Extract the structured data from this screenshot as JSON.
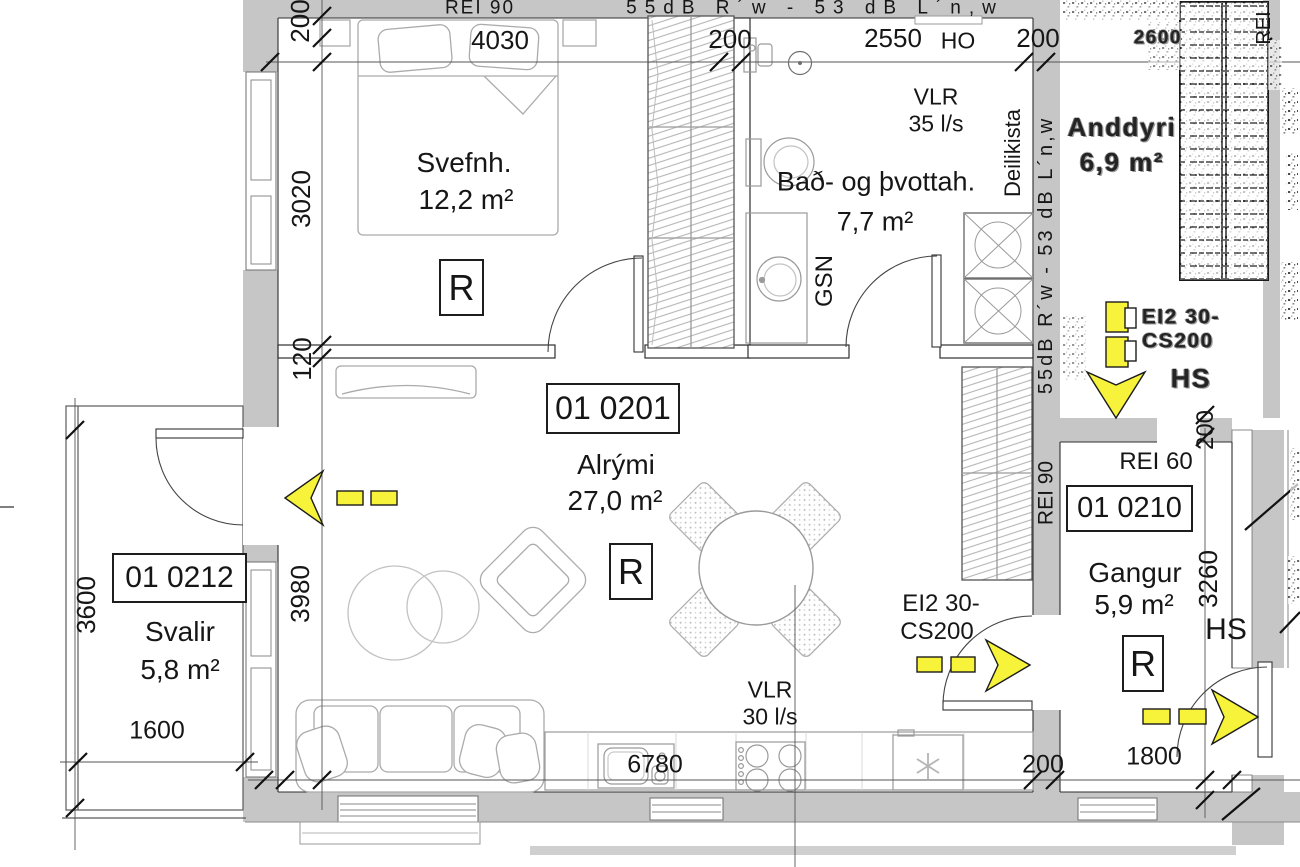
{
  "plan": {
    "rooms": {
      "alrymi": {
        "id": "01 0201",
        "name": "Alrými",
        "area": "27,0 m²"
      },
      "svefnherbergi": {
        "name": "Svefnh.",
        "area": "12,2 m²"
      },
      "bad_og_thvottahus": {
        "name": "Bað- og þvottah.",
        "area": "7,7 m²"
      },
      "svalir": {
        "id": "01 0212",
        "name": "Svalir",
        "area": "5,8 m²"
      },
      "gangur": {
        "id": "01 0210",
        "name": "Gangur",
        "area": "5,9 m²"
      },
      "anddyri": {
        "name": "Anddyri",
        "area": "6,9 m²"
      }
    },
    "radiator": "R",
    "fire": {
      "top_rei": "REI 90",
      "top_sound": "55dB R´w - 53 dB L´n,w",
      "right_sound": "55dB R´w - 53 dB L´n,w",
      "right_rei": "REI 90",
      "gangur_rei": "REI 60",
      "stair_rei": "REI",
      "door_l1": "EI2 30-",
      "door_l2": "CS200",
      "door_noisy_l1": "EI2 30-",
      "door_noisy_l2": "CS200"
    },
    "vent": {
      "bath_l1": "VLR",
      "bath_l2": "35 l/s",
      "kitchen_l1": "VLR",
      "kitchen_l2": "30 l/s"
    },
    "labels": {
      "ho": "HO",
      "gsn": "GSN",
      "deilikista": "Deilikista",
      "hs": "HS",
      "hs_noisy": "HS"
    },
    "dims": {
      "top_4030": "4030",
      "top_200a": "200",
      "top_2550": "2550",
      "top_200b": "200",
      "left_200": "200",
      "left_3020": "3020",
      "left_120": "120",
      "left_3980": "3980",
      "svalir_3600": "3600",
      "svalir_1600": "1600",
      "kitchen_6780": "6780",
      "kitchen_200": "200",
      "gangur_200": "200",
      "gangur_3260": "3260",
      "gangur_1800": "1800",
      "corridor_2600": "2600"
    }
  }
}
